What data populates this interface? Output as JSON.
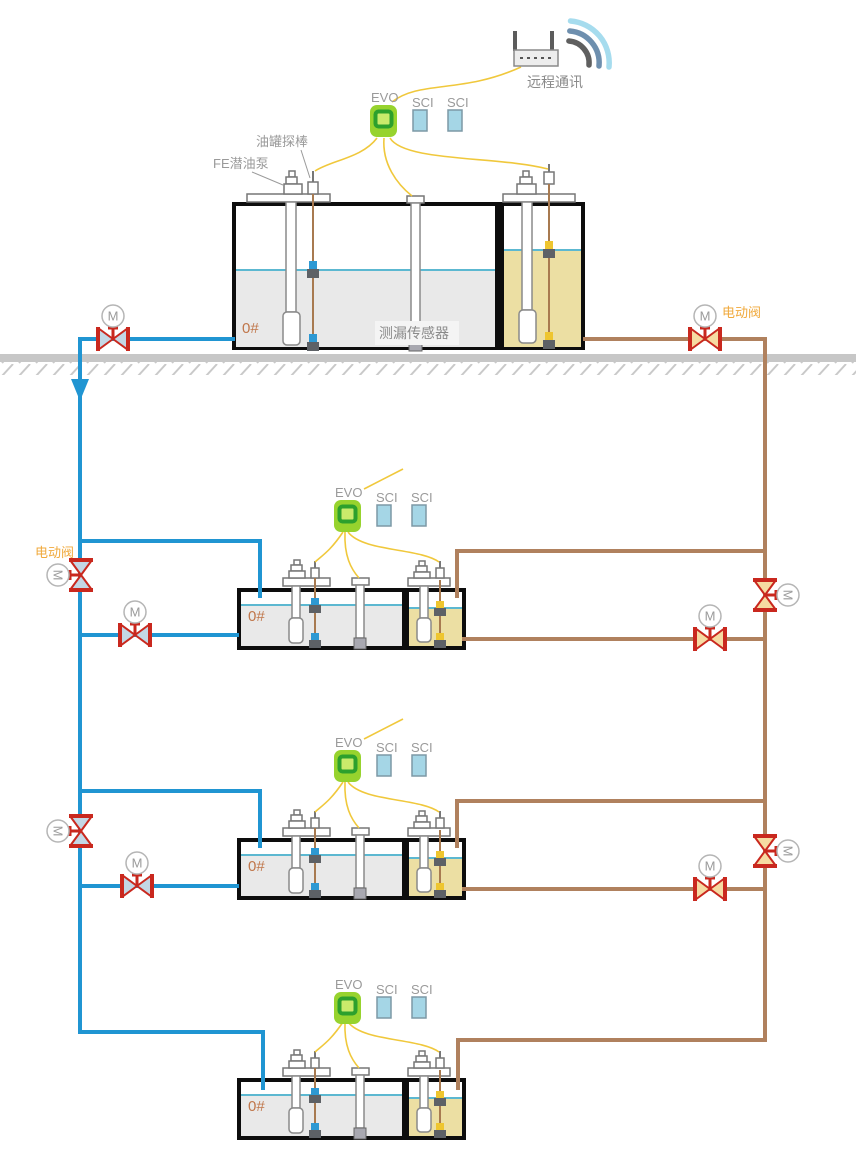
{
  "labels": {
    "evo": "EVO",
    "sci": "SCI",
    "motor": "M",
    "fuel_grade": "0#"
  },
  "annotations": {
    "remote_comm": "远程通讯",
    "tank_probe": "油罐探棒",
    "submersible_pump": "FE潜油泵",
    "leak_sensor": "测漏传感器",
    "electric_valve": "电动阀"
  },
  "colors": {
    "diesel_pipe_blue": "#2095d2",
    "gasoline_pipe_brown": "#b0815e",
    "signal_wire_yellow": "#f0c83c",
    "valve_red": "#c9281e",
    "evo_green": "#97d32e",
    "sci_blue": "#a5d6e6",
    "diesel_fill": "#e9e9e9",
    "gasoline_fill": "#ecdfa3",
    "liquid_line": "#5cb8d1",
    "grade_text": "#c0764a",
    "label_gray": "#9a9a9a",
    "electric_valve_label_orange": "#f0a93c"
  }
}
